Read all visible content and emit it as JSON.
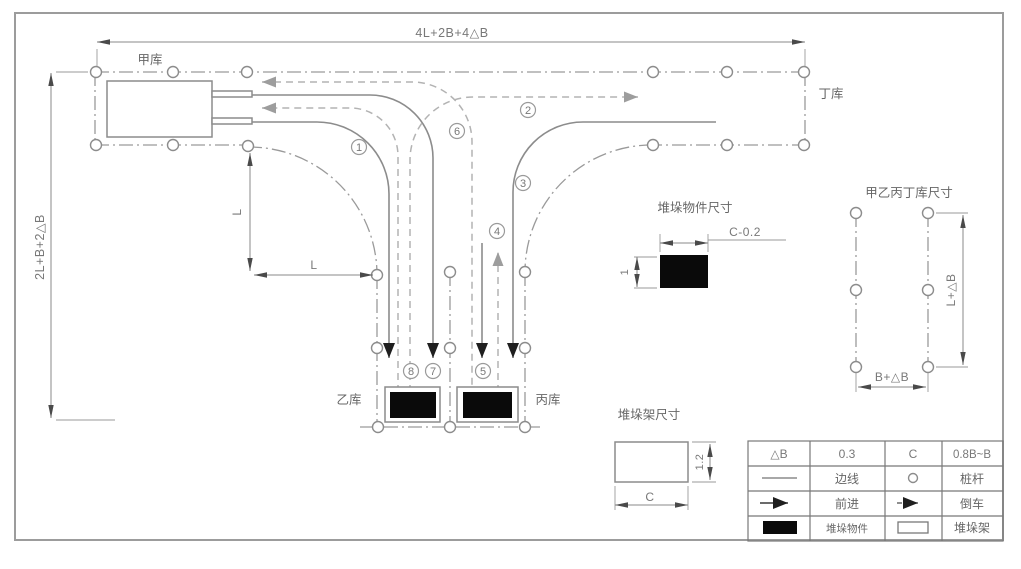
{
  "diagram": {
    "warehouses": {
      "a": "甲库",
      "b": "乙库",
      "c": "丙库",
      "d": "丁库"
    },
    "dimensions": {
      "top_width": "4L+2B+4△B",
      "left_height": "2L+B+2△B",
      "turn_radius_vertical": "L",
      "turn_radius_horizontal": "L",
      "object_width": "C-0.2",
      "object_height": "1",
      "rack_width": "C",
      "rack_height": "1.2",
      "warehouse_height": "L+△B",
      "warehouse_width": "B+△B"
    },
    "detail_titles": {
      "object_size": "堆垛物件尺寸",
      "rack_size": "堆垛架尺寸",
      "warehouse_size": "甲乙丙丁库尺寸"
    },
    "route_markers": [
      "1",
      "2",
      "3",
      "4",
      "5",
      "6",
      "7",
      "8"
    ],
    "legend": {
      "delta_b_label": "△B",
      "delta_b_value": "0.3",
      "c_label": "C",
      "c_value": "0.8B~B",
      "edge_line": "边线",
      "pole": "桩杆",
      "forward": "前进",
      "reverse": "倒车",
      "stack_object": "堆垛物件",
      "stack_rack": "堆垛架"
    },
    "colors": {
      "line_gray": "#8c8c8c",
      "boundary_gray": "#9a9a9a",
      "reverse_gray": "#b3b3b3",
      "fill_black": "#0a0a0a",
      "background": "#ffffff"
    }
  }
}
